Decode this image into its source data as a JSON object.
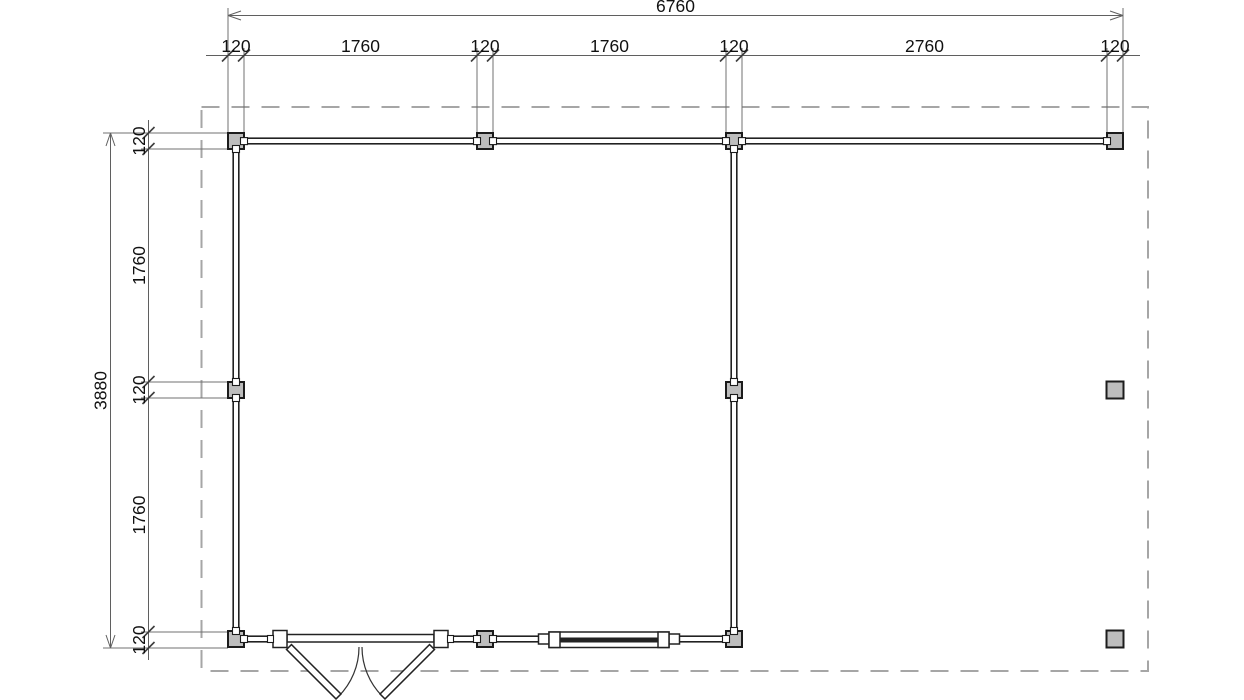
{
  "dimensions": {
    "top": {
      "total": "6760",
      "segments": [
        "120",
        "1760",
        "120",
        "1760",
        "120",
        "2760",
        "120"
      ]
    },
    "left": {
      "total": "3880",
      "segments": [
        "120",
        "1760",
        "120",
        "1760",
        "120"
      ]
    }
  },
  "colors": {
    "background": "#ffffff",
    "wall_line": "#222222",
    "post_fill": "#bdbdbd",
    "post_border": "#1c1c1c",
    "dimension_line": "#5f5f5f",
    "dimension_text": "#111111",
    "roof_overhang_dash": "#a6a6a6"
  }
}
